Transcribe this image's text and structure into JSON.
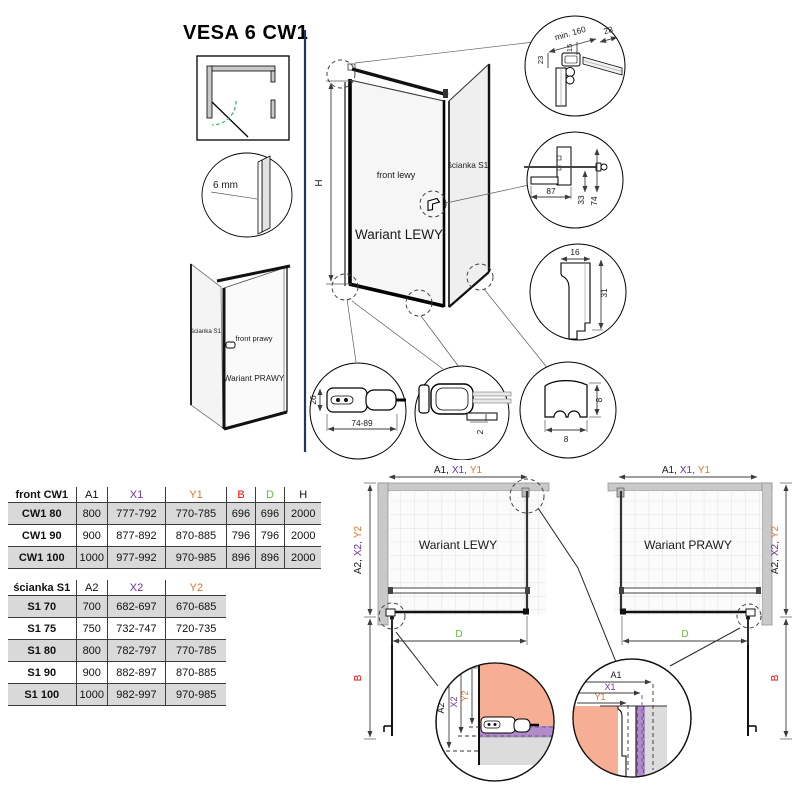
{
  "title": "VESA 6 CW1",
  "glass": {
    "thickness": "6 mm"
  },
  "main_drawing": {
    "height_dim": "H",
    "front_label": "front lewy",
    "wall_label": "ścianka S1",
    "variant": "Wariant LEWY"
  },
  "small_drawing": {
    "wall_label": "ścianka S1",
    "front_label": "front prawy",
    "variant": "Wariant PRAWY"
  },
  "details": {
    "top_mount": {
      "min_width": "min. 160",
      "w28": "28",
      "h15": "15",
      "h23": "23"
    },
    "wall_bracket": {
      "w87": "87",
      "h33": "33",
      "h74": "74"
    },
    "wall_profile": {
      "w16": "16",
      "h31": "31"
    },
    "handle": {
      "h26": "26",
      "range": "74-89"
    },
    "bottom_hinge": {
      "gap": "2"
    },
    "wall_clamp": {
      "w8": "8",
      "h8": "8"
    }
  },
  "dims": {
    "a1": "A1",
    "x1": "X1",
    "y1": "Y1",
    "a2": "A2",
    "x2": "X2",
    "y2": "Y2",
    "a1c": "A1,",
    "x1c": "X1,",
    "a2c": "A2,",
    "x2c": "X2,",
    "b": "B",
    "d": "D"
  },
  "schematics": {
    "lewy": {
      "variant": "Wariant LEWY"
    },
    "prawy": {
      "variant": "Wariant PRAWY"
    }
  },
  "tables": {
    "front": {
      "name": "front CW1",
      "headers": [
        "A1",
        "X1",
        "Y1",
        "B",
        "D",
        "H"
      ],
      "rows": [
        {
          "label": "CW1 80",
          "values": [
            "800",
            "777-792",
            "770-785",
            "696",
            "696",
            "2000"
          ]
        },
        {
          "label": "CW1 90",
          "values": [
            "900",
            "877-892",
            "870-885",
            "796",
            "796",
            "2000"
          ]
        },
        {
          "label": "CW1 100",
          "values": [
            "1000",
            "977-992",
            "970-985",
            "896",
            "896",
            "2000"
          ]
        }
      ]
    },
    "wall": {
      "name": "ścianka S1",
      "headers": [
        "A2",
        "X2",
        "Y2"
      ],
      "rows": [
        {
          "label": "S1 70",
          "values": [
            "700",
            "682-697",
            "670-685"
          ]
        },
        {
          "label": "S1 75",
          "values": [
            "750",
            "732-747",
            "720-735"
          ]
        },
        {
          "label": "S1 80",
          "values": [
            "800",
            "782-797",
            "770-785"
          ]
        },
        {
          "label": "S1 90",
          "values": [
            "900",
            "882-897",
            "870-885"
          ]
        },
        {
          "label": "S1 100",
          "values": [
            "1000",
            "982-997",
            "970-985"
          ]
        }
      ]
    }
  },
  "colors": {
    "x_dim": "#7030A0",
    "y_dim": "#E8732A",
    "b_dim": "#FF0000",
    "d_dim": "#66B83C",
    "divider": "#22355F",
    "glass_highlight": "#F6AE94",
    "profile_highlight": "#B08CC8"
  }
}
